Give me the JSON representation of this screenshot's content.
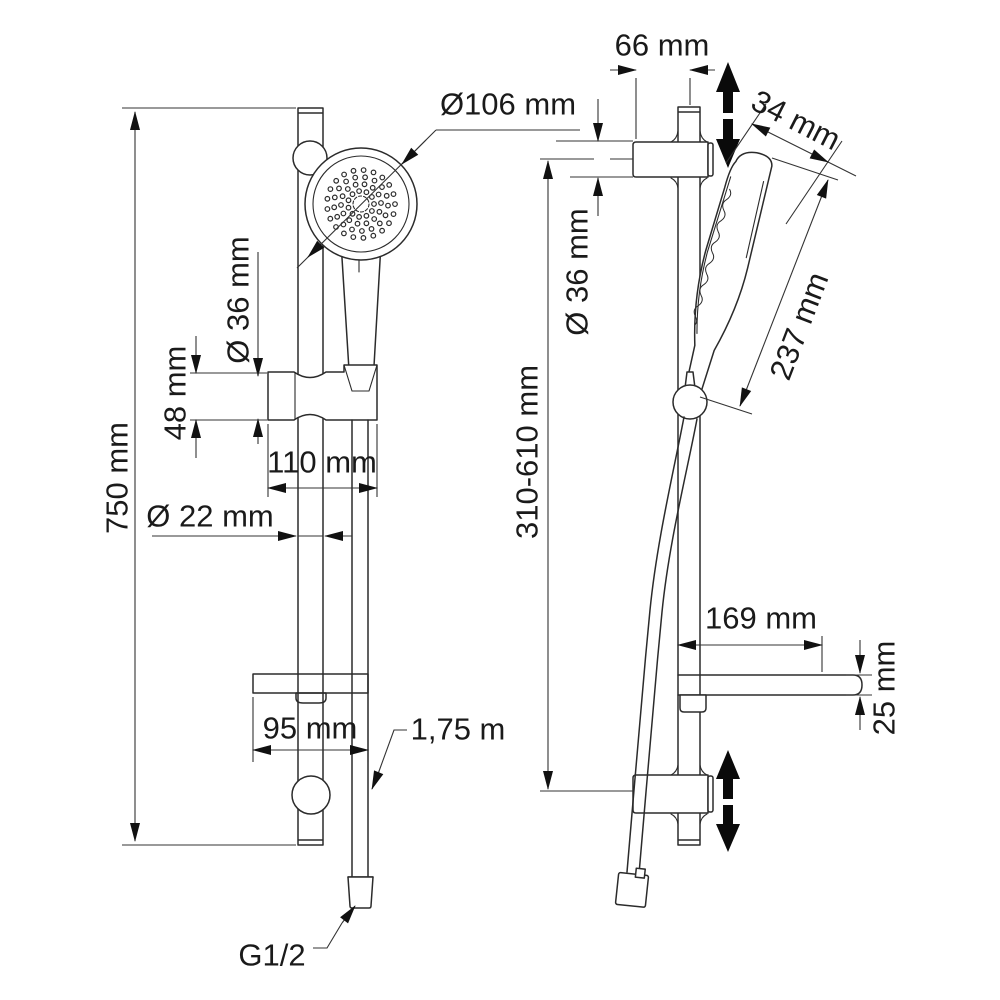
{
  "drawing": "shower-set-dimensional-drawing",
  "colors": {
    "line": "#2b2b2b",
    "dimension_line": "#333333",
    "background": "#ffffff",
    "movement_arrow": "#0a0a0a"
  },
  "front_view": {
    "total_height": "750 mm",
    "head_diameter": "Ø106 mm",
    "holder_diameter": "Ø 36 mm",
    "holder_height": "48 mm",
    "holder_width": "110 mm",
    "rail_diameter": "Ø 22 mm",
    "shelf_width": "95 mm",
    "hose_length": "1,75 m",
    "connector_thread": "G1/2"
  },
  "side_view": {
    "wall_offset": "66 mm",
    "head_thickness": "34 mm",
    "bracket_diameter": "Ø 36 mm",
    "handset_length": "237 mm",
    "holder_adjust_range": "310-610 mm",
    "shelf_depth": "169 mm",
    "shelf_thickness": "25 mm"
  },
  "icons": {
    "height_adjust": "double-arrow-up-down"
  }
}
